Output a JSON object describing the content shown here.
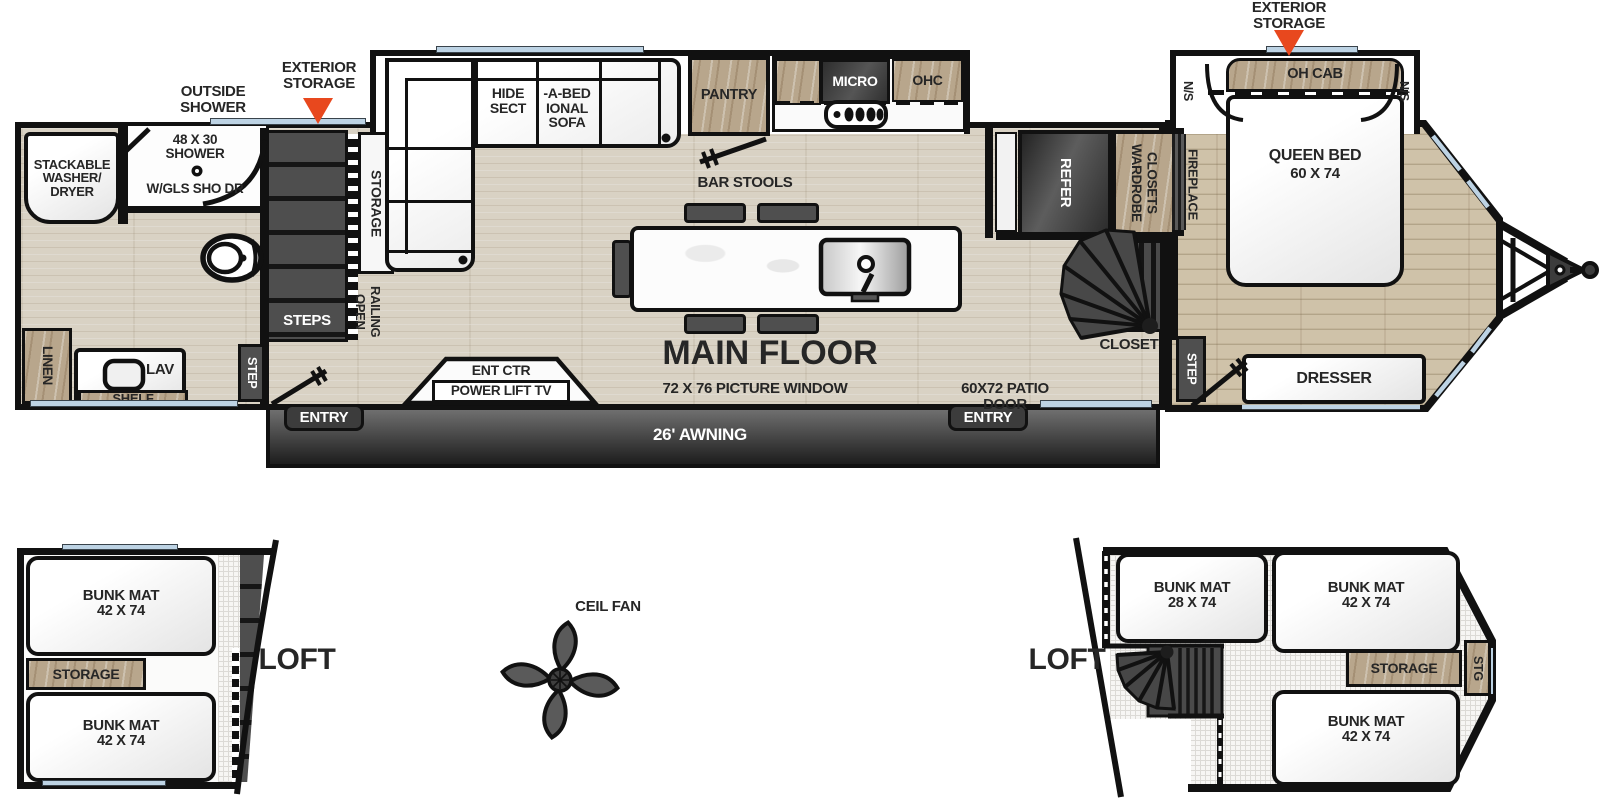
{
  "colors": {
    "wall": "#111111",
    "floor_wood": "#d9d2c4",
    "bedroom_wood": "#cfc2a9",
    "cabinet_wood": "#b8a68c",
    "dark_fixture": "#4f4f4f",
    "window_glass": "#bdd3e4",
    "storage_marker": "#e8481e"
  },
  "callouts": {
    "outside_shower": "OUTSIDE SHOWER",
    "exterior_storage": "EXTERIOR STORAGE"
  },
  "main_floor": {
    "title": "MAIN FLOOR",
    "bathroom": {
      "washer_dryer": "STACKABLE WASHER/ DRYER",
      "shower_size": "48 X 30",
      "shower": "SHOWER",
      "shower_door": "W/GLS SHO DR",
      "linen": "LINEN",
      "lav": "LAV",
      "shelf": "SHELF"
    },
    "stairs": {
      "steps": "STEPS",
      "step": "STEP",
      "storage": "STORAGE",
      "open_railing": "OPEN RAILING"
    },
    "living": {
      "sofa_left": "HIDE SECT",
      "sofa_right": "-A-BED IONAL SOFA",
      "bar_stools": "BAR STOOLS",
      "ent_ctr": "ENT CTR",
      "power_lift_tv": "POWER LIFT TV",
      "picture_window": "72 X 76 PICTURE WINDOW"
    },
    "kitchen": {
      "pantry": "PANTRY",
      "micro": "MICRO",
      "ohc": "OHC",
      "refer": "REFER"
    },
    "bedroom": {
      "wardrobe": "WARDROBE CLOSETS",
      "fireplace": "FIREPLACE",
      "closet": "CLOSET",
      "step": "STEP",
      "oh_cab": "OH CAB",
      "ns": "N/S",
      "queen_bed": "QUEEN BED",
      "queen_size": "60 X 74",
      "dresser": "DRESSER"
    },
    "exterior": {
      "patio_door": "60X72 PATIO DOOR",
      "awning": "26' AWNING",
      "entry": "ENTRY"
    }
  },
  "lofts": {
    "left": {
      "label": "LOFT",
      "bunk_top_title": "BUNK MAT",
      "bunk_top_size": "42 X 74",
      "storage": "STORAGE",
      "bunk_bottom_title": "BUNK MAT",
      "bunk_bottom_size": "42 X 74"
    },
    "right": {
      "label": "LOFT",
      "bunk_a_title": "BUNK MAT",
      "bunk_a_size": "28 X 74",
      "bunk_b_title": "BUNK MAT",
      "bunk_b_size": "42 X 74",
      "bunk_c_title": "BUNK MAT",
      "bunk_c_size": "42 X 74",
      "storage": "STORAGE",
      "stg": "STG"
    }
  },
  "ceiling_fan": {
    "label": "CEIL FAN"
  }
}
